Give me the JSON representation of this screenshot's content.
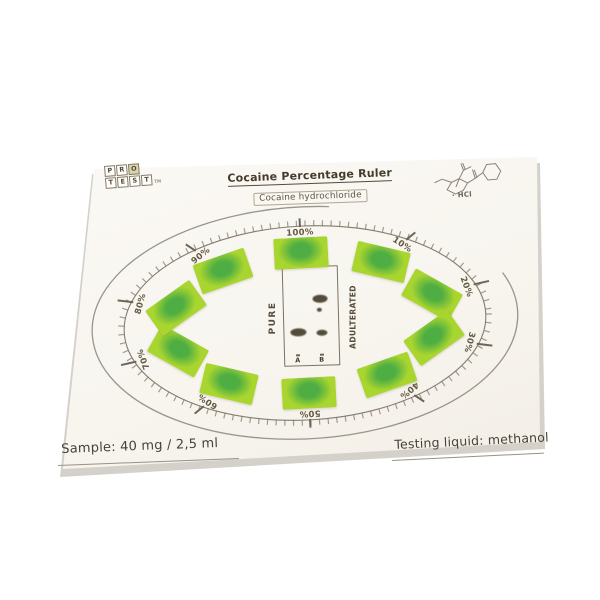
{
  "logo": {
    "row1": [
      "P",
      "R",
      "O"
    ],
    "row2": [
      "T",
      "E",
      "S",
      "T"
    ],
    "trademark": "TM"
  },
  "header": {
    "title": "Cocaine Percentage Ruler",
    "subtitle": "Cocaine hydrochloride",
    "molecule_note": "· HCl"
  },
  "dial": {
    "percent_labels": [
      "100%",
      "10%",
      "20%",
      "30%",
      "40%",
      "50%",
      "60%",
      "70%",
      "80%",
      "90%"
    ],
    "panel": {
      "left_label": "PURE",
      "right_label": "ADULTERATED",
      "lane_a": "A",
      "lane_b": "B"
    }
  },
  "footer": {
    "sample": "Sample: 40 mg / 2,5 ml",
    "testing_liquid": "Testing liquid: methanol"
  },
  "colors": {
    "card_bg": "#f8f5f0",
    "ink": "#4a4136",
    "line": "#847c6e",
    "swatch_base": "#a9d52f",
    "swatch_blob": "#4fae43"
  }
}
